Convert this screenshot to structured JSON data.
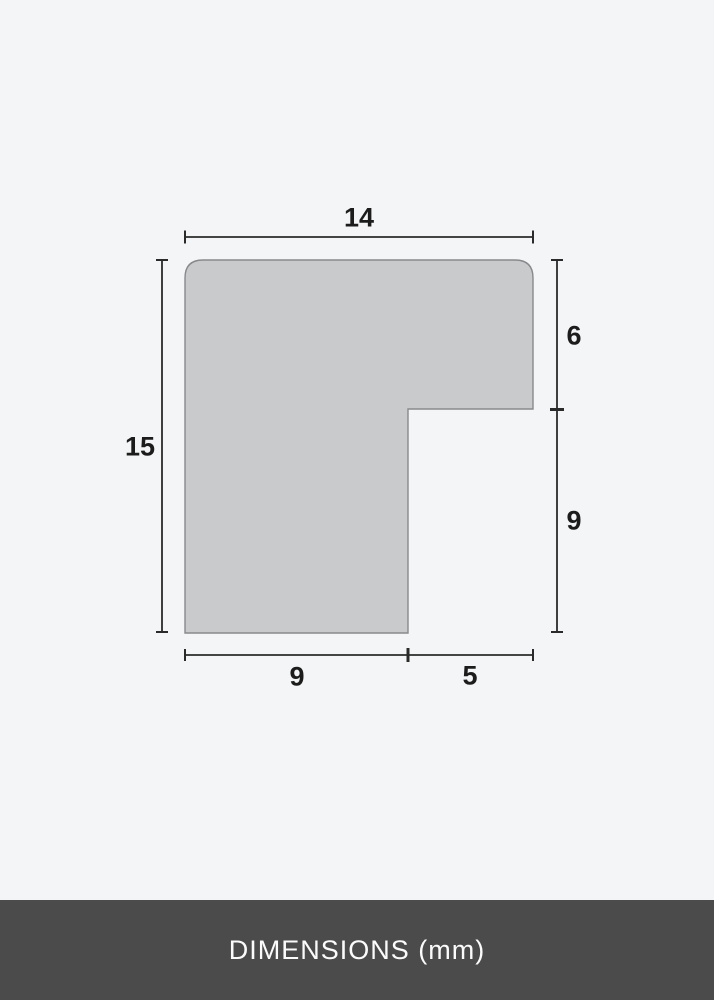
{
  "diagram": {
    "unit": "mm",
    "shape": {
      "kind": "frame-moulding-profile-cross-section",
      "fill": "#c9cacb",
      "stroke": "#87898c"
    },
    "line_color": "#2a2a2a",
    "labels": {
      "total_width": "14",
      "total_height": "15",
      "right_upper": "6",
      "right_lower": "9",
      "bottom_left": "9",
      "bottom_right": "5"
    },
    "measurements_mm": {
      "total_width": 14,
      "total_height": 15,
      "right_upper_depth": 6,
      "right_lower_depth": 9,
      "bottom_left_width": 9,
      "bottom_right_width": 5
    }
  },
  "footer": {
    "label": "DIMENSIONS (mm)",
    "background": "#4b4b4b",
    "text_color": "#fbfbfb"
  }
}
